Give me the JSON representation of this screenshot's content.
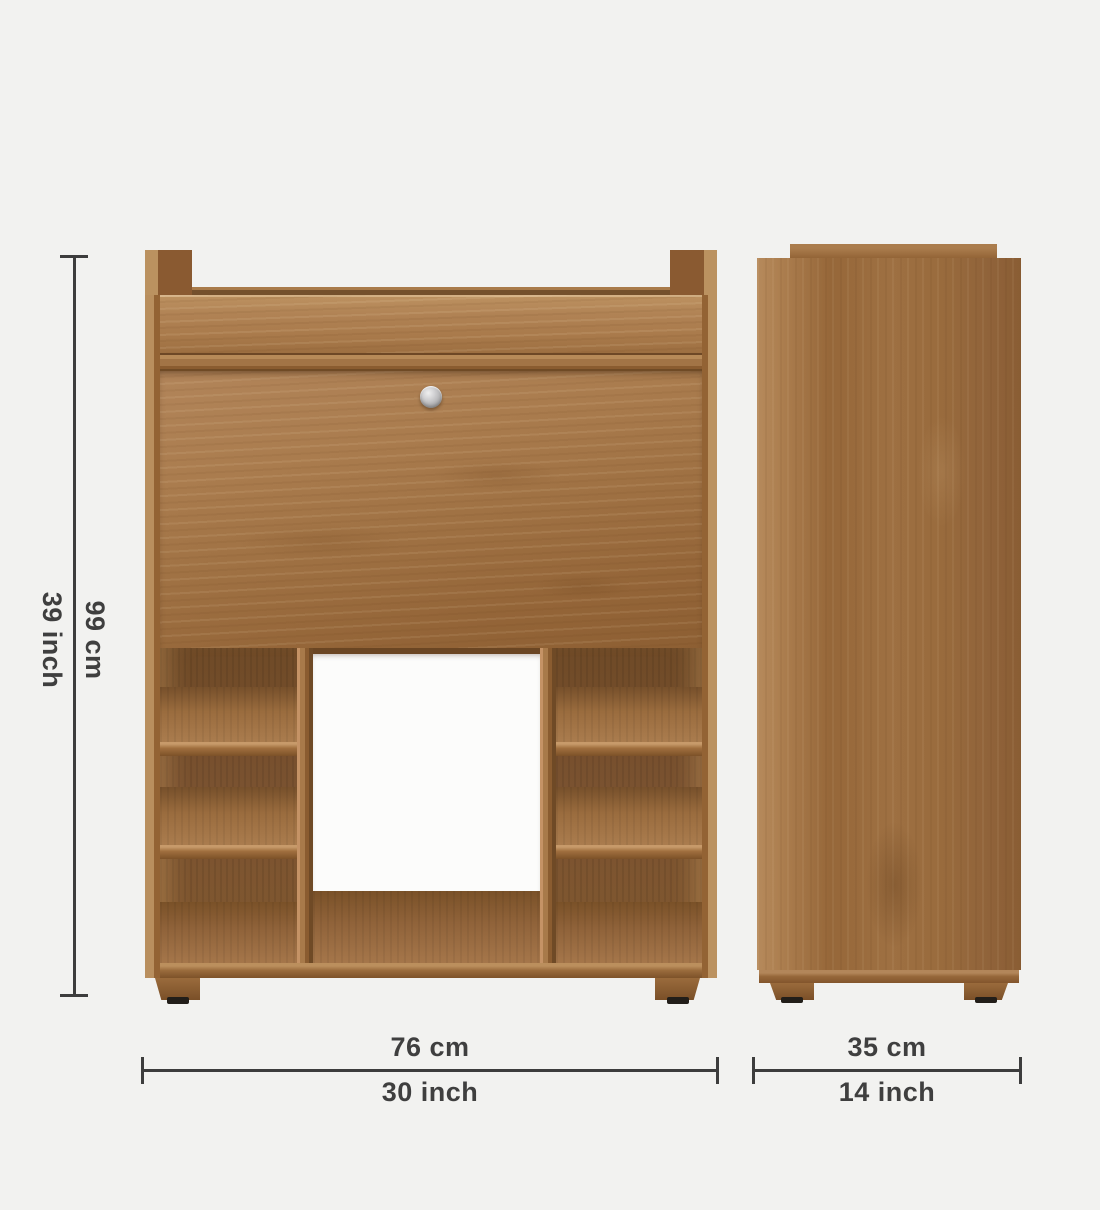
{
  "diagram": {
    "kind": "furniture-dimension-diagram",
    "subject": "wooden cabinet with drop-down door, open shelves, front view and side view"
  },
  "dimensions": {
    "height": {
      "cm": "99 cm",
      "inch": "39 inch"
    },
    "width": {
      "cm": "76 cm",
      "inch": "30 inch"
    },
    "depth": {
      "cm": "35 cm",
      "inch": "14 inch"
    }
  },
  "colors": {
    "background": "#f2f2f0",
    "dimension_line": "#3d3d3d",
    "dimension_text": "#3f3f3f",
    "wood_light": "#b68a5c",
    "wood_mid": "#9b6d3f",
    "wood_dark": "#6f4a27",
    "open_back_white": "#fcfcfb",
    "knob_metal": "#c6c6c8",
    "foot_pad": "#221e19"
  },
  "icons": {
    "knob": "door-knob-icon"
  }
}
